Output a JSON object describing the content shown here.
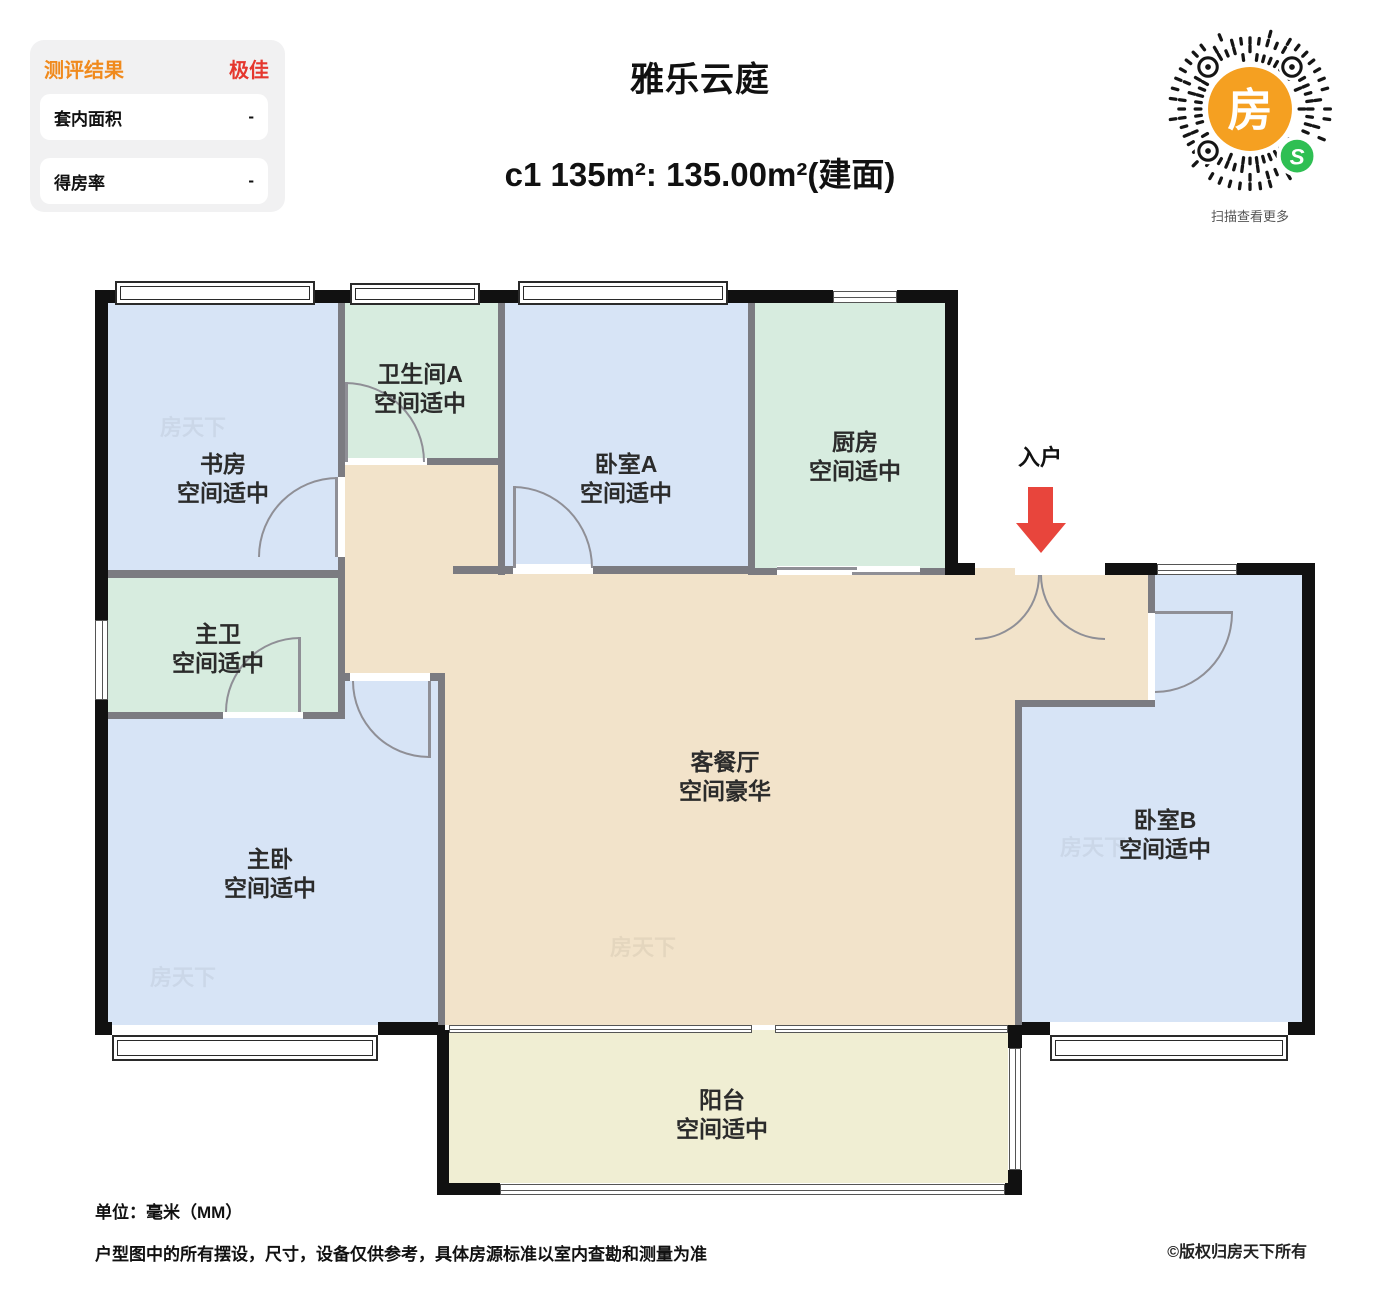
{
  "header": {
    "panel": {
      "title": "测评结果",
      "grade": "极佳",
      "rows": [
        {
          "label": "套内面积",
          "value": "-"
        },
        {
          "label": "得房率",
          "value": "-"
        }
      ]
    },
    "title": "雅乐云庭",
    "subtitle": "c1 135m²: 135.00m²(建面)",
    "qr": {
      "center_glyph": "房",
      "badge_glyph": "S",
      "caption": "扫描查看更多",
      "orange": "#f5a021",
      "green": "#2fbf53"
    }
  },
  "plan": {
    "entrance_label": "入户",
    "watermark": "房天下",
    "rooms": [
      {
        "id": "study",
        "name": "书房",
        "desc": "空间适中"
      },
      {
        "id": "bath-a",
        "name": "卫生间A",
        "desc": "空间适中"
      },
      {
        "id": "bed-a",
        "name": "卧室A",
        "desc": "空间适中"
      },
      {
        "id": "kitchen",
        "name": "厨房",
        "desc": "空间适中"
      },
      {
        "id": "master-bath",
        "name": "主卫",
        "desc": "空间适中"
      },
      {
        "id": "living",
        "name": "客餐厅",
        "desc": "空间豪华"
      },
      {
        "id": "master-bed",
        "name": "主卧",
        "desc": "空间适中"
      },
      {
        "id": "bed-b",
        "name": "卧室B",
        "desc": "空间适中"
      },
      {
        "id": "balcony",
        "name": "阳台",
        "desc": "空间适中"
      }
    ],
    "colors": {
      "bedroom_fill": "#d7e4f6",
      "bath_kitchen_fill": "#d7ecdf",
      "living_fill": "#f2e3ca",
      "balcony_fill": "#f0eed3",
      "exterior_wall": "#111111",
      "partition_wall": "#7b7b81",
      "entrance_arrow": "#e8453c"
    }
  },
  "footer": {
    "unit": "单位：毫米（MM）",
    "disclaimer": "户型图中的所有摆设，尺寸，设备仅供参考，具体房源标准以室内查勘和测量为准",
    "copyright": "©版权归房天下所有"
  }
}
